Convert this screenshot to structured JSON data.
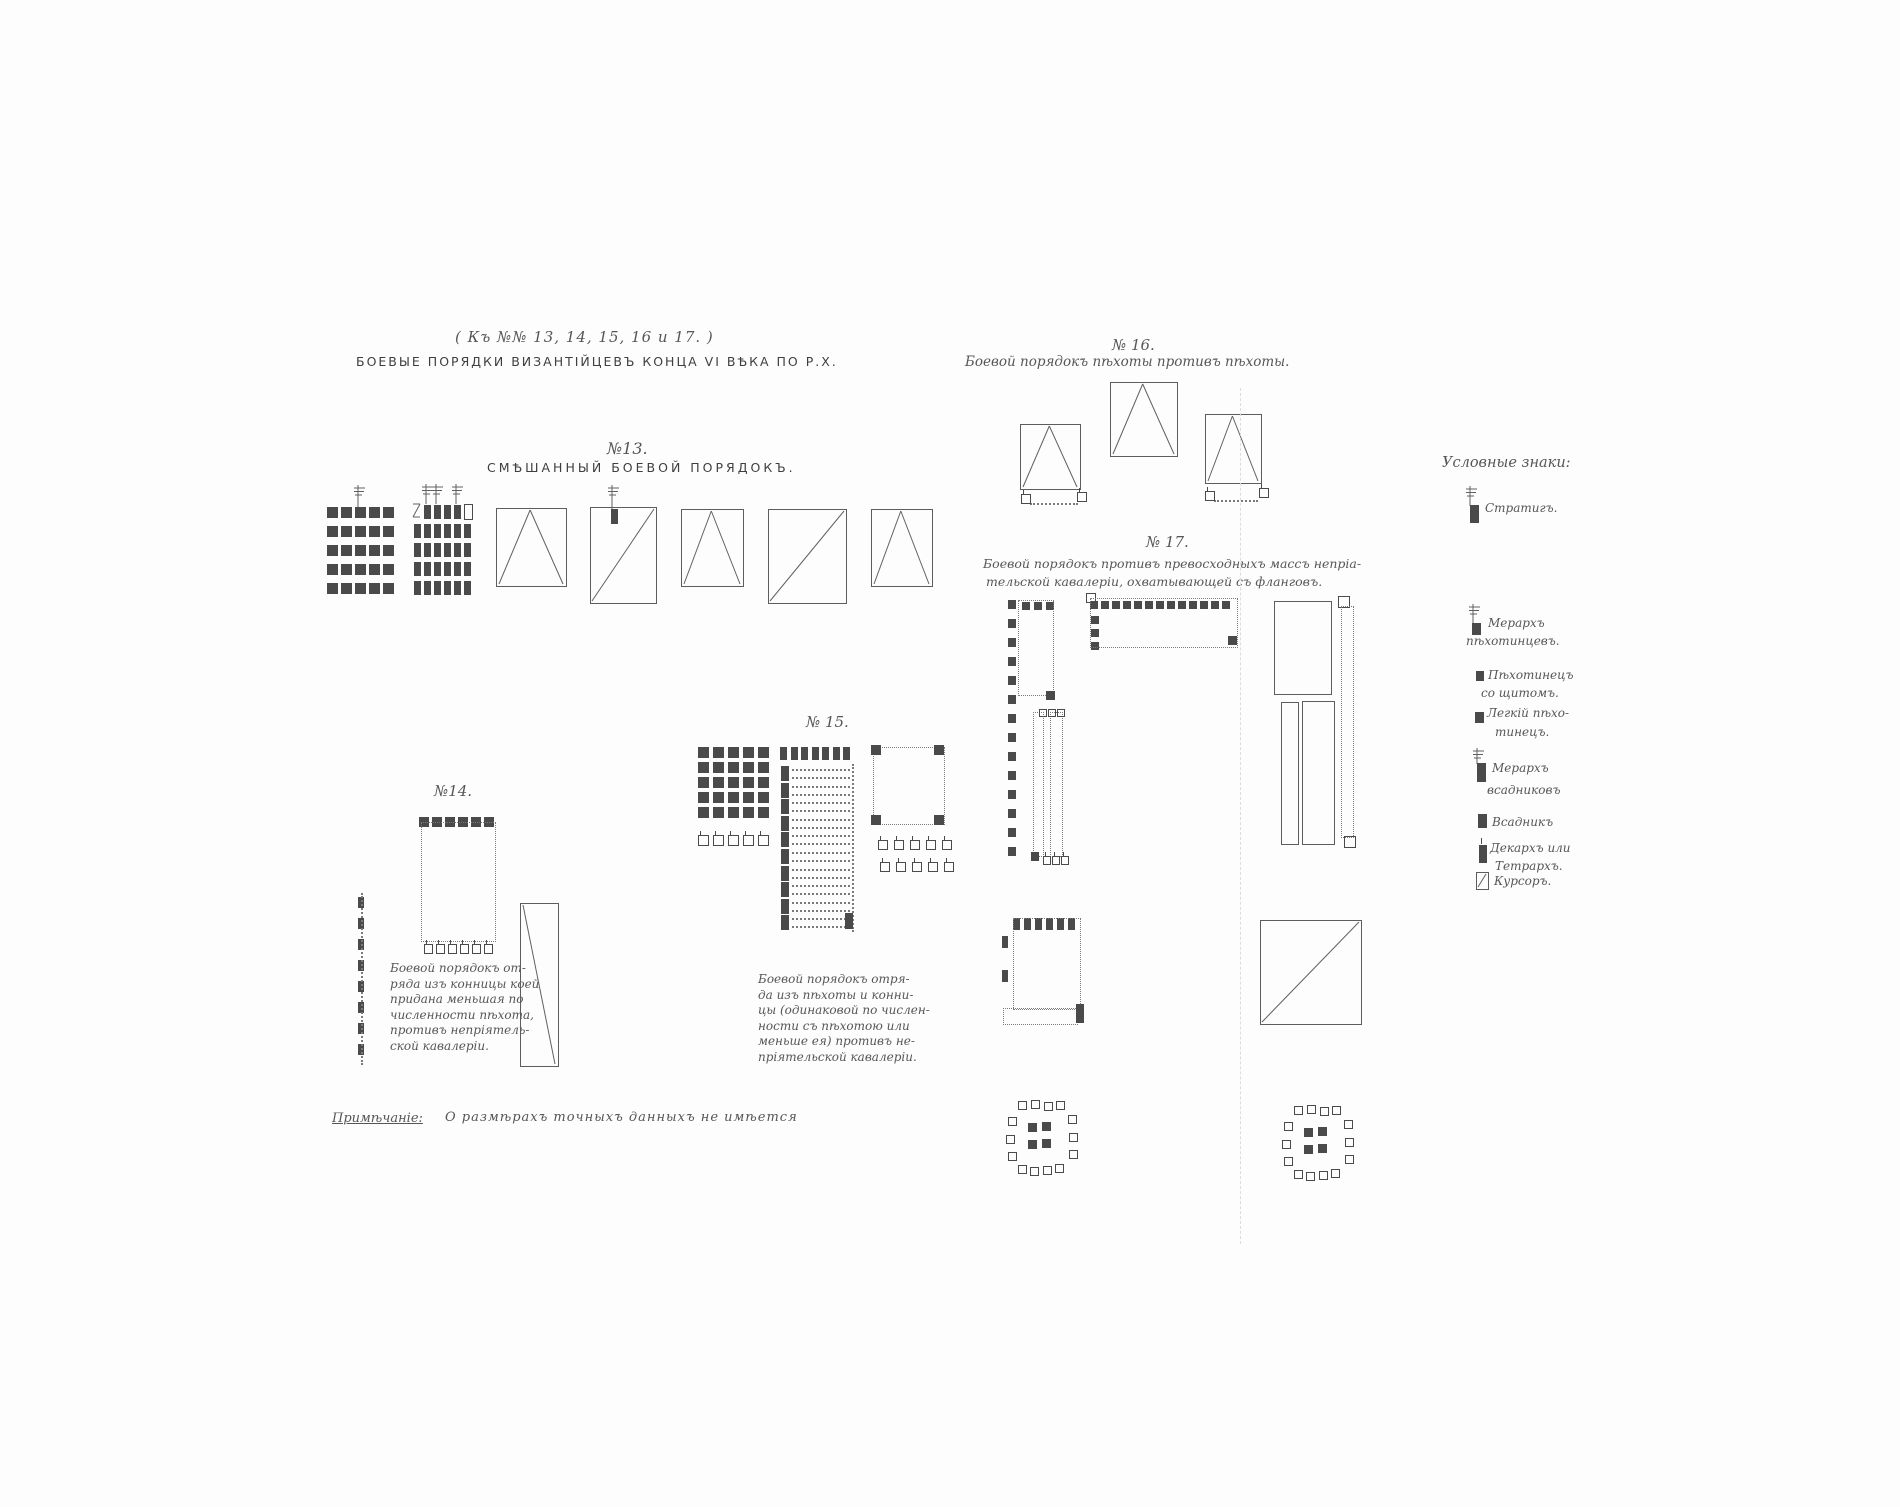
{
  "ink": "#4a4a4a",
  "page": {
    "header_ref": "( Къ №№ 13, 14, 15, 16 и 17. )",
    "title": "БОЕВЫЕ ПОРЯДКИ ВИЗАНТІЙЦЕВЪ КОНЦА VI ВѢКА ПО Р.Х.",
    "note_label": "Примѣчаніе:",
    "note_text": "О размѣрахъ точныхъ данныхъ не имѣется"
  },
  "figures": {
    "f13": {
      "number": "№13.",
      "title": "СМѢШАННЫЙ БОЕВОЙ ПОРЯДОКЪ."
    },
    "f14": {
      "number": "№14.",
      "caption": [
        "Боевой порядокъ от-",
        "ряда изъ конницы коей",
        "придана меньшая по",
        "численности пѣхота,",
        "противъ непріятель-",
        "ской кавалеріи."
      ]
    },
    "f15": {
      "number": "№ 15.",
      "caption": [
        "Боевой порядокъ отря-",
        "да изъ пѣхоты и конни-",
        "цы (одинаковой по числен-",
        "ности съ пѣхотою или",
        "меньше ея) противъ не-",
        "пріятельской кавалеріи."
      ]
    },
    "f16": {
      "number": "№ 16.",
      "caption": "Боевой порядокъ пѣхоты противъ пѣхоты."
    },
    "f17": {
      "number": "№ 17.",
      "caption": [
        "Боевой порядокъ противъ превосходныхъ массъ непріа-",
        "тельской кавалеріи, охватывающей съ фланговъ."
      ]
    }
  },
  "legend": {
    "title": "Условные знаки:",
    "items": [
      {
        "icon": "strategos-flag-bar-icon",
        "lines": [
          "Стратигъ."
        ]
      },
      {
        "icon": "merarch-infantry-flag-square-icon",
        "lines": [
          "Мерархъ",
          "пѣхотинцевъ."
        ]
      },
      {
        "icon": "infantry-with-shield-square-icon",
        "lines": [
          "Пѣхотинецъ",
          "со щитомъ."
        ]
      },
      {
        "icon": "light-infantryman-square-icon",
        "lines": [
          "Легкій пѣхо-",
          "тинецъ."
        ]
      },
      {
        "icon": "merarch-cavalry-flag-bar-icon",
        "lines": [
          "Мерархъ",
          "всадниковъ"
        ]
      },
      {
        "icon": "horseman-bar-icon",
        "lines": [
          "Всадникъ"
        ]
      },
      {
        "icon": "decarch-tetrarch-bar-icon",
        "lines": [
          "Декархъ или",
          "Тетрархъ."
        ]
      },
      {
        "icon": "koursor-slashed-rect-icon",
        "lines": [
          "Курсоръ."
        ]
      }
    ]
  }
}
